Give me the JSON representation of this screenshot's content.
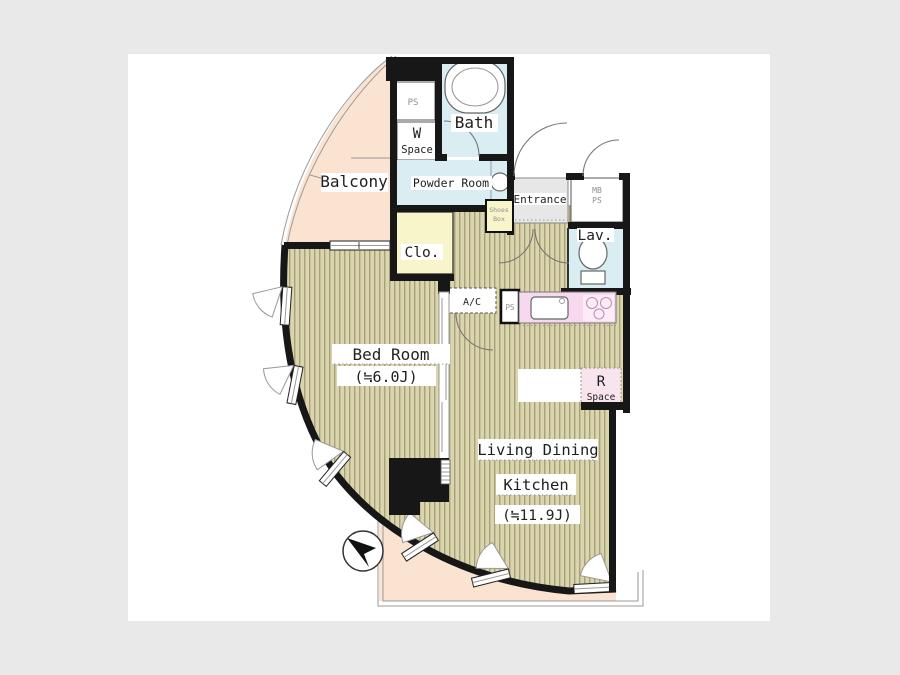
{
  "page": {
    "background": "#e9e9e9"
  },
  "floor_plan": {
    "labels": {
      "balcony": "Balcony",
      "ps_top": "PS",
      "bath": "Bath",
      "w": "W",
      "w_space": "Space",
      "powder_room": "Powder Room",
      "shoes_line1": "Shoes",
      "shoes_line2": "Box",
      "entrance": "Entrance",
      "mb": "MB",
      "mb_ps": "PS",
      "lav": "Lav.",
      "clo": "Clo.",
      "ac": "A/C",
      "kitchen_ps": "PS",
      "r": "R",
      "r_space": "Space",
      "bed_room": "Bed Room",
      "bed_room_size": "(≒6.0J)",
      "ldk_line1": "Living Dining",
      "ldk_line2": "Kitchen",
      "ldk_size": "(≒11.9J)"
    },
    "colors": {
      "page_bg": "#e9e9e9",
      "plan_bg": "#ffffff",
      "wall": "#171717",
      "floor": "#dbd5ad",
      "floor_stripe": "#a8a07a",
      "balcony": "#fbe3d1",
      "water": "#d9edf2",
      "closet": "#f8f5cb",
      "kitchen": "#f6d9ee",
      "stove": "#fdebf7",
      "entrance_floor": "#e7e7e7",
      "r_space": "#f8e4ec",
      "label": "#1f1f1f",
      "small_label": "#8f8f8f"
    }
  }
}
